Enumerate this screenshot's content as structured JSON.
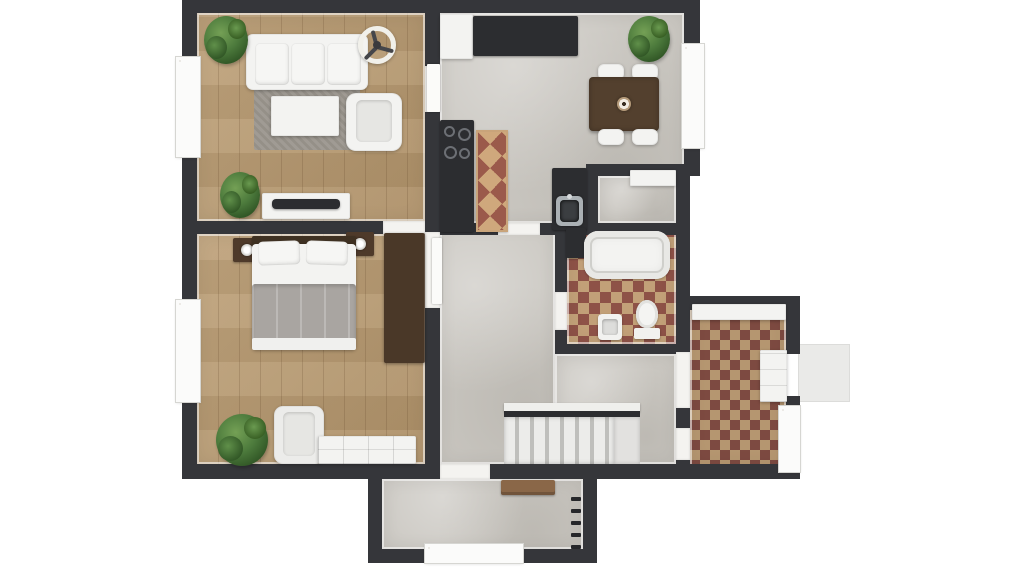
{
  "scene": {
    "type": "3d-floor-plan-top-down-view",
    "rooms": [
      {
        "id": "living-room",
        "floor": "wood",
        "items": [
          "sofa",
          "ceiling-fan",
          "coffee-table",
          "armchair",
          "area-rug",
          "tv-console",
          "potted-plant-large",
          "potted-plant-small"
        ]
      },
      {
        "id": "bedroom",
        "floor": "wood",
        "items": [
          "double-bed",
          "nightstand-left",
          "nightstand-right",
          "table-lamps",
          "wardrobe",
          "armchair",
          "dresser",
          "potted-plant"
        ]
      },
      {
        "id": "kitchen-dining",
        "floor": "concrete",
        "items": [
          "refrigerator",
          "wall-counter",
          "cooktop-counter",
          "runner-rug",
          "sink-counter",
          "kitchen-sink",
          "dining-table",
          "dining-chairs-x4",
          "table-centerpiece",
          "potted-plant"
        ]
      },
      {
        "id": "closet",
        "floor": "concrete",
        "items": [
          "shelf"
        ]
      },
      {
        "id": "bathroom",
        "floor": "checker-tile",
        "items": [
          "bathtub",
          "toilet",
          "washbasin",
          "dark-cabinet"
        ]
      },
      {
        "id": "hallway",
        "floor": "concrete",
        "items": [
          "staircase",
          "stair-landing"
        ]
      },
      {
        "id": "mudroom",
        "floor": "checker-tile",
        "items": [
          "counter-shelf",
          "storage-cabinet",
          "glass-patio-door"
        ]
      },
      {
        "id": "vestibule",
        "floor": "concrete",
        "items": [
          "entry-bench",
          "coat-hooks-x5",
          "glazed-entry-door"
        ]
      }
    ],
    "windows": [
      "living-room-left",
      "bedroom-left",
      "dining-right"
    ],
    "exterior": [
      "doorstep-pad-right"
    ]
  },
  "palette": {
    "wall": "#35363a",
    "wood": "#b8996e",
    "concrete": "#cac7c1",
    "checker_red": "#8e5247",
    "checker_tan": "#c2a078",
    "mud_red": "#7d4a41",
    "mud_tan": "#b59670",
    "runner_red": "#9b5a4b",
    "runner_tan": "#cfa87c",
    "rug": "#9b968e",
    "furn_white": "#f3f3f1",
    "counter_dark": "#2c2d30",
    "wood_dark": "#4e3a2a",
    "bench": "#8a6748",
    "blanket": "#a9a5a1",
    "plant": "#4c7a3c",
    "glass": "#bdb7ab",
    "pad": "#eaeae8"
  }
}
